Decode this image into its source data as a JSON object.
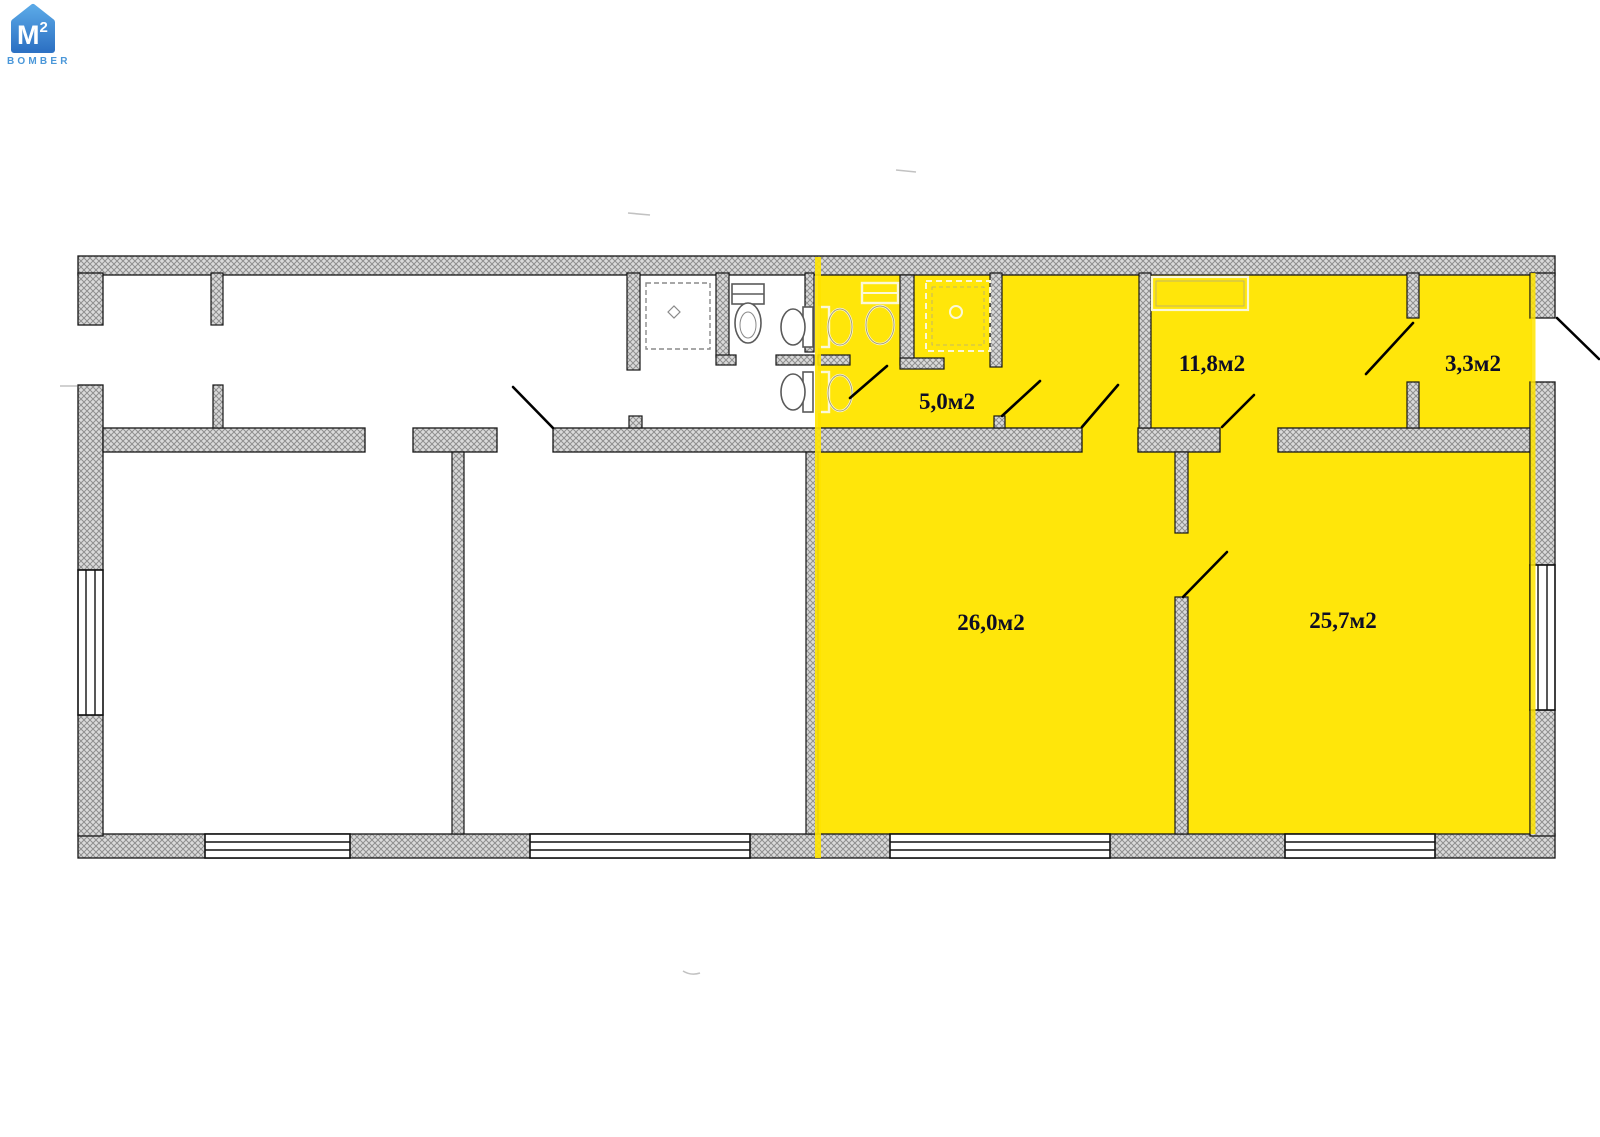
{
  "logo": {
    "monogram": "M",
    "superscript": "2",
    "brand": "BOMBER"
  },
  "floor_plan": {
    "unit_suffix": "м2",
    "rooms": [
      {
        "name": "sanitary-block",
        "area_label": "5,0м2"
      },
      {
        "name": "room-11-8",
        "area_label": "11,8м2"
      },
      {
        "name": "room-3-3",
        "area_label": "3,3м2"
      },
      {
        "name": "room-26-0",
        "area_label": "26,0м2"
      },
      {
        "name": "room-25-7",
        "area_label": "25,7м2"
      }
    ],
    "colors": {
      "highlight": "#ffe60a",
      "highlight_line": "#ffe400",
      "label": "#0d0d26",
      "wall_outline": "#161616",
      "logo_blue": "#4a97d9"
    }
  }
}
